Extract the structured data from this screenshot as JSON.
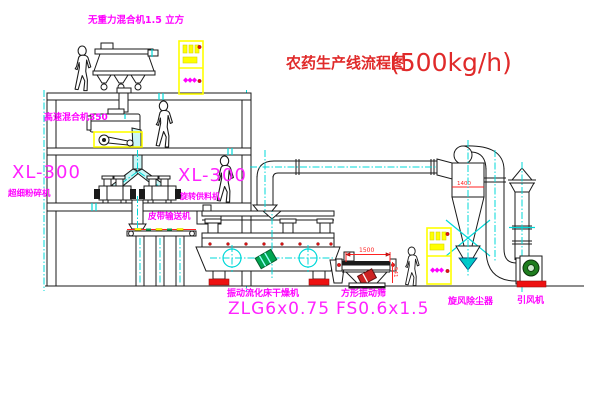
{
  "diagram": {
    "title": "农药生产线流程图",
    "capacity": "(500kg/h)"
  },
  "equipment": {
    "gravity_mixer": "无重力混合机1.5 立方",
    "high_speed_mixer": "高速混合机350",
    "mill_model": "XL-300",
    "mill_name": "超细粉碎机",
    "feeder_model": "XL-300",
    "feeder_name": "旋转供料机",
    "belt_conveyor": "皮带输送机",
    "dryer_name": "振动流化床干燥机",
    "dryer_model": "ZLG6x0.75",
    "sieve_name": "方形振动筛",
    "sieve_model": "FS0.6x1.5",
    "cyclone_name": "旋风除尘器",
    "fan_name": "引风机"
  },
  "dimensions": {
    "sieve_length": "1500",
    "sieve_height": "541",
    "cyclone_size": "1400"
  },
  "cabinet": {
    "indicator": "◆◆◆"
  },
  "colors": {
    "line": "#1a1a1a",
    "label_magenta": "#ff00ff",
    "title_red": "#e02a2a",
    "dimension_red": "#ff2222",
    "centerline_cyan": "#00d8d8",
    "cabinet_yellow": "#ffff00",
    "motor_green": "#00a550",
    "base_red": "#ee1111",
    "background": "#ffffff"
  }
}
